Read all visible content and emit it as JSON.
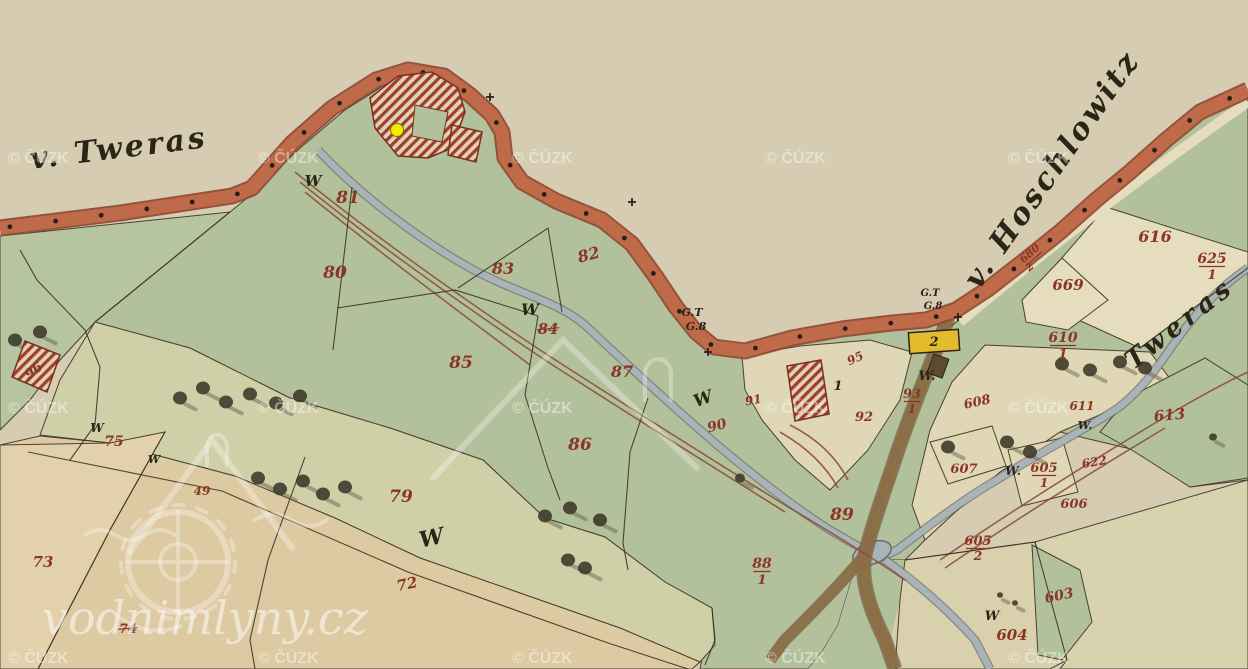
{
  "map": {
    "title": "Historic cadastral map sheet (Tweras / Hoschlowitz)",
    "colors": {
      "paper": "#d5ccb1",
      "band": "#bf6b4a",
      "bandedge": "#8f4630",
      "green": "#b2c19b",
      "green2": "#b7c4a0",
      "strip": "#cfd0a8",
      "tan": "#ddcaa2",
      "tan2": "#e2d1ab",
      "cream": "#e6ddbe",
      "cream2": "#e0d7b6",
      "creambr": "#d9d1ad",
      "tanbr": "#d8d2ae",
      "stream": "#a9b3ba",
      "streamedge": "#6b6b60",
      "road": "#8a6e46",
      "roadedge": "#5f4a2e",
      "redline": "#8a4a33",
      "redtext": "#8b3526",
      "ink": "#2b2417",
      "greentext": "#2f4a28",
      "hatch": "#a33c2a",
      "hatchbg": "#ddd3b6",
      "yellowbld": "#e2bc2c",
      "marker": "#f2ea00",
      "watermark": "#ffffff"
    },
    "region_labels": [
      {
        "t": "v. Tweras",
        "x": 120,
        "y": 158,
        "s": 30,
        "r": -7,
        "ls": 3,
        "n": "label-village-tweras"
      },
      {
        "t": "v. Hoschlowitz",
        "x": 1060,
        "y": 175,
        "s": 30,
        "r": -55,
        "ls": 3,
        "n": "label-village-hoschlowitz"
      },
      {
        "t": "Tweras",
        "x": 1185,
        "y": 330,
        "s": 26,
        "r": -38,
        "ls": 5,
        "c": "greentext",
        "n": "label-stream-tweras"
      }
    ],
    "parcel_numbers": [
      {
        "t": "81",
        "x": 348,
        "y": 203,
        "s": 17
      },
      {
        "t": "80",
        "x": 335,
        "y": 278,
        "s": 17
      },
      {
        "t": "83",
        "x": 503,
        "y": 274,
        "s": 16
      },
      {
        "t": "82",
        "x": 590,
        "y": 260,
        "s": 16,
        "r": -15
      },
      {
        "t": "84",
        "x": 548,
        "y": 334,
        "s": 15,
        "strike": true
      },
      {
        "t": "85",
        "x": 461,
        "y": 368,
        "s": 17
      },
      {
        "t": "87",
        "x": 622,
        "y": 377,
        "s": 16
      },
      {
        "t": "86",
        "x": 580,
        "y": 450,
        "s": 17
      },
      {
        "t": "75",
        "x": 114,
        "y": 446,
        "s": 14
      },
      {
        "t": "49",
        "x": 202,
        "y": 495,
        "s": 12
      },
      {
        "t": "79",
        "x": 401,
        "y": 502,
        "s": 17
      },
      {
        "t": "72",
        "x": 408,
        "y": 589,
        "s": 15,
        "r": -12
      },
      {
        "t": "73",
        "x": 43,
        "y": 567,
        "s": 15
      },
      {
        "t": "74",
        "x": 128,
        "y": 633,
        "s": 13,
        "strike": true
      },
      {
        "t": "88",
        "x": 762,
        "y": 568,
        "s": 14,
        "den": "1"
      },
      {
        "t": "89",
        "x": 842,
        "y": 520,
        "s": 17
      },
      {
        "t": "90",
        "x": 718,
        "y": 430,
        "s": 14,
        "r": -15
      },
      {
        "t": "91",
        "x": 754,
        "y": 404,
        "s": 12,
        "r": -10
      },
      {
        "t": "95",
        "x": 857,
        "y": 362,
        "s": 12,
        "r": -25
      },
      {
        "t": "92",
        "x": 864,
        "y": 421,
        "s": 13
      },
      {
        "t": "93",
        "x": 912,
        "y": 398,
        "s": 13,
        "den": "1"
      },
      {
        "t": "96",
        "x": 36,
        "y": 374,
        "s": 13,
        "r": -35
      },
      {
        "t": "608",
        "x": 978,
        "y": 406,
        "s": 13,
        "r": -12
      },
      {
        "t": "607",
        "x": 964,
        "y": 473,
        "s": 13
      },
      {
        "t": "605",
        "x": 1044,
        "y": 472,
        "s": 13,
        "den": "1"
      },
      {
        "t": "605",
        "x": 978,
        "y": 545,
        "s": 13,
        "den": "2"
      },
      {
        "t": "606",
        "x": 1074,
        "y": 508,
        "s": 13
      },
      {
        "t": "603",
        "x": 1060,
        "y": 600,
        "s": 14,
        "r": -12
      },
      {
        "t": "604",
        "x": 1012,
        "y": 640,
        "s": 15
      },
      {
        "t": "616",
        "x": 1155,
        "y": 242,
        "s": 16
      },
      {
        "t": "625",
        "x": 1212,
        "y": 263,
        "s": 14,
        "den": "1"
      },
      {
        "t": "669",
        "x": 1068,
        "y": 290,
        "s": 15
      },
      {
        "t": "610",
        "x": 1063,
        "y": 342,
        "s": 14,
        "den": "1"
      },
      {
        "t": "611",
        "x": 1082,
        "y": 410,
        "s": 12
      },
      {
        "t": "622",
        "x": 1095,
        "y": 466,
        "s": 12,
        "r": -10
      },
      {
        "t": "613",
        "x": 1170,
        "y": 420,
        "s": 15,
        "r": -6
      },
      {
        "t": "680",
        "x": 1032,
        "y": 256,
        "s": 11,
        "r": -42,
        "den": "2"
      }
    ],
    "w_marks": [
      {
        "t": "W",
        "x": 313,
        "y": 186,
        "s": 15
      },
      {
        "t": "W",
        "x": 530,
        "y": 315,
        "s": 16
      },
      {
        "t": "W",
        "x": 705,
        "y": 404,
        "s": 17,
        "r": -20
      },
      {
        "t": "W",
        "x": 433,
        "y": 545,
        "s": 22,
        "r": -12
      },
      {
        "t": "W",
        "x": 97,
        "y": 432,
        "s": 12
      },
      {
        "t": "W",
        "x": 154,
        "y": 463,
        "s": 11
      },
      {
        "t": "W.",
        "x": 927,
        "y": 380,
        "s": 13
      },
      {
        "t": "W.",
        "x": 1013,
        "y": 475,
        "s": 12
      },
      {
        "t": "W",
        "x": 992,
        "y": 620,
        "s": 13
      },
      {
        "t": "W.",
        "x": 1085,
        "y": 429,
        "s": 11
      }
    ],
    "gt_marks": [
      {
        "t": "G.T",
        "x": 692,
        "y": 316,
        "s": 11
      },
      {
        "t": "G.8",
        "x": 696,
        "y": 330,
        "s": 11
      },
      {
        "t": "G.T",
        "x": 930,
        "y": 296,
        "s": 10
      },
      {
        "t": "G.8",
        "x": 933,
        "y": 309,
        "s": 10
      }
    ],
    "house_numbers": [
      {
        "t": "1",
        "x": 838,
        "y": 390,
        "s": 13
      },
      {
        "t": "2",
        "x": 934,
        "y": 346,
        "s": 13
      }
    ],
    "symbols": {
      "crosses": [
        {
          "x": 490,
          "y": 97
        },
        {
          "x": 632,
          "y": 202
        },
        {
          "x": 708,
          "y": 352
        },
        {
          "x": 958,
          "y": 317
        }
      ]
    },
    "trees": [
      {
        "x": 15,
        "y": 340
      },
      {
        "x": 40,
        "y": 332
      },
      {
        "x": 180,
        "y": 398
      },
      {
        "x": 203,
        "y": 388
      },
      {
        "x": 226,
        "y": 402
      },
      {
        "x": 250,
        "y": 394
      },
      {
        "x": 276,
        "y": 403
      },
      {
        "x": 300,
        "y": 396
      },
      {
        "x": 258,
        "y": 478
      },
      {
        "x": 280,
        "y": 489
      },
      {
        "x": 303,
        "y": 481
      },
      {
        "x": 323,
        "y": 494
      },
      {
        "x": 345,
        "y": 487
      },
      {
        "x": 545,
        "y": 516
      },
      {
        "x": 570,
        "y": 508
      },
      {
        "x": 600,
        "y": 520
      },
      {
        "x": 568,
        "y": 560
      },
      {
        "x": 585,
        "y": 568
      },
      {
        "x": 740,
        "y": 478,
        "r": 5
      },
      {
        "x": 948,
        "y": 447
      },
      {
        "x": 1007,
        "y": 442
      },
      {
        "x": 1030,
        "y": 452
      },
      {
        "x": 1062,
        "y": 364
      },
      {
        "x": 1090,
        "y": 370
      },
      {
        "x": 1120,
        "y": 362
      },
      {
        "x": 1145,
        "y": 368
      },
      {
        "x": 1213,
        "y": 437,
        "r": 4
      },
      {
        "x": 1000,
        "y": 595,
        "r": 3
      },
      {
        "x": 1015,
        "y": 603,
        "r": 3
      }
    ],
    "marker": {
      "x": 397,
      "y": 130,
      "color": "#f2ea00",
      "meaning": "highlighted water mill site"
    },
    "watermarks": {
      "cuzk": {
        "text": "© ČÚZK",
        "cols": [
          8,
          258,
          512,
          765,
          1008
        ],
        "rows": [
          163,
          413,
          663
        ]
      },
      "site": {
        "text": "vodnimlyny.cz",
        "x": 42,
        "y": 634,
        "size": 46
      }
    }
  }
}
